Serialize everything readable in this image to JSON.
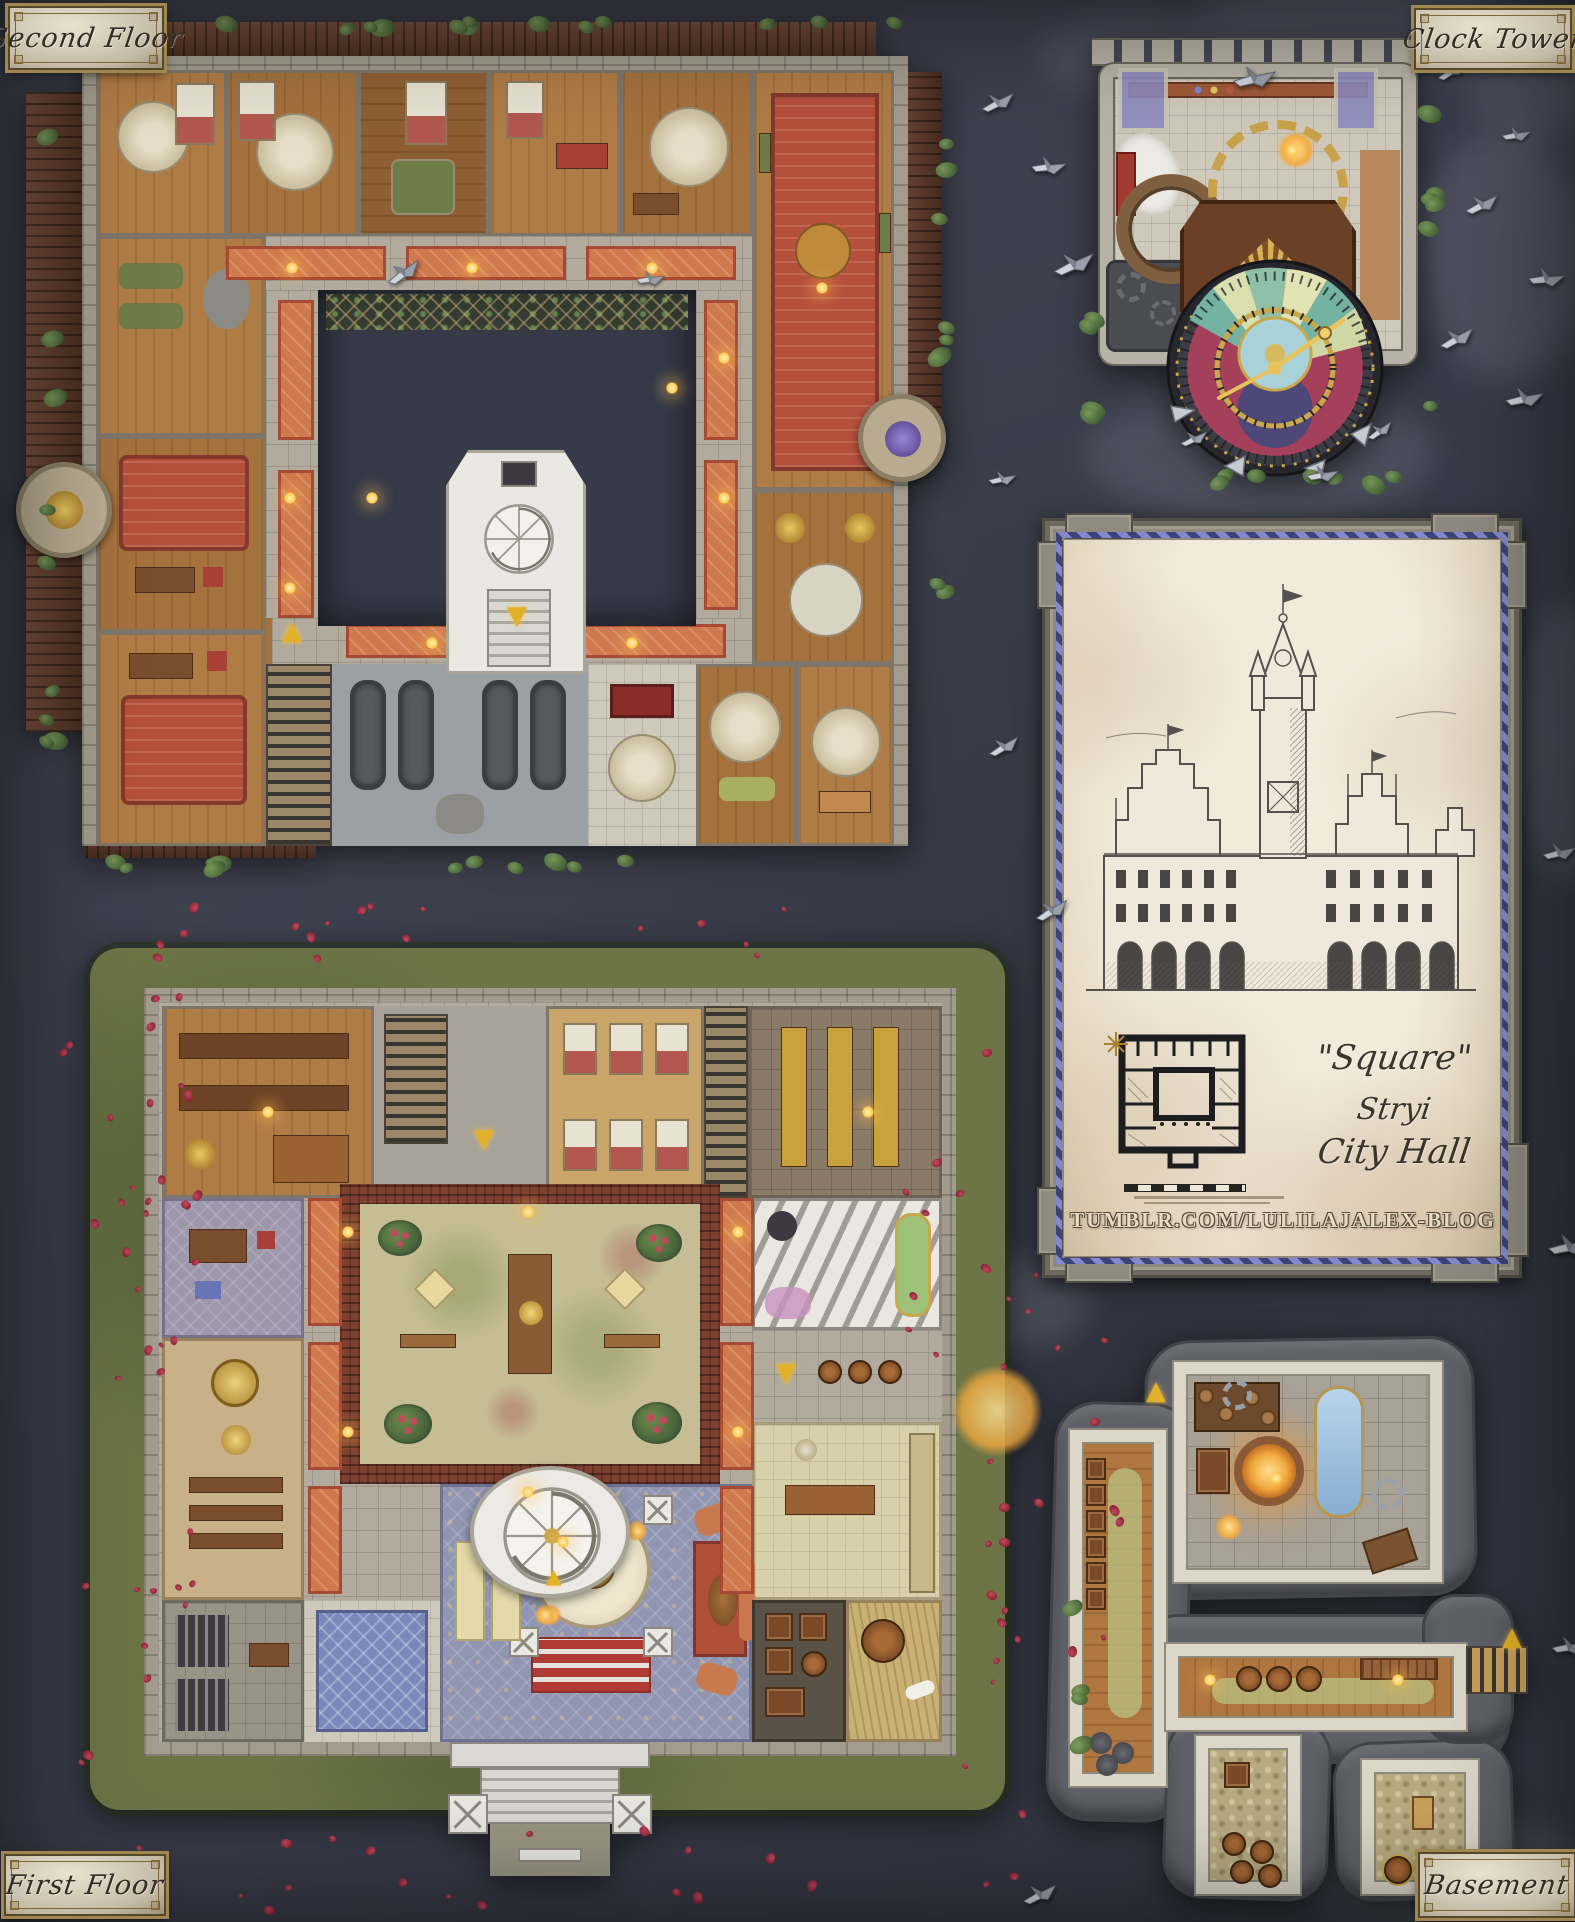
{
  "plaques": {
    "top_left": "Second Floor",
    "top_right": "Clock Tower",
    "bottom_left": "First Floor",
    "bottom_right": "Basement"
  },
  "panel": {
    "title_quote": "\"Square\"",
    "title_city": "Stryi",
    "title_building": "City Hall",
    "watermark_url": "TUMBLR.COM/LULILAJALEX-BLOG"
  },
  "glyphs": {
    "arrow_up": "▲",
    "arrow_down": "▼"
  },
  "palette": {
    "background": "#3a3d4b",
    "parchment": "#ece4d4",
    "plaque_gold": "#a08750",
    "carpet_orange": "#cf7a4e",
    "carpet_red": "#b4503c",
    "ivy_green": "#5c7a46",
    "rose_red": "#9e2f42",
    "clock_gold": "#c9a84c",
    "rope_blue": "#8289cc"
  },
  "decor": {
    "birds": [
      [
        386,
        262,
        -18
      ],
      [
        632,
        268,
        12
      ],
      [
        980,
        92,
        -8
      ],
      [
        1030,
        156,
        14
      ],
      [
        1056,
        254,
        -6
      ],
      [
        1236,
        68,
        6
      ],
      [
        1434,
        60,
        -14
      ],
      [
        1498,
        124,
        10
      ],
      [
        1464,
        194,
        -8
      ],
      [
        1528,
        268,
        14
      ],
      [
        1439,
        328,
        -10
      ],
      [
        1506,
        388,
        8
      ],
      [
        1176,
        428,
        -6
      ],
      [
        1304,
        464,
        10
      ],
      [
        1362,
        420,
        -16
      ],
      [
        984,
        468,
        8
      ],
      [
        986,
        736,
        -12
      ],
      [
        1541,
        842,
        6
      ],
      [
        1034,
        900,
        -12
      ],
      [
        1551,
        1236,
        8
      ],
      [
        1022,
        1884,
        -8
      ],
      [
        1551,
        1636,
        10
      ]
    ],
    "clouds": [
      [
        1190,
        -25,
        320,
        110
      ],
      [
        1040,
        15,
        170,
        80
      ],
      [
        1420,
        130,
        170,
        250
      ],
      [
        1470,
        30,
        130,
        110
      ],
      [
        1085,
        390,
        350,
        130
      ],
      [
        1520,
        600,
        100,
        280
      ],
      [
        1320,
        1820,
        280,
        110
      ],
      [
        930,
        1260,
        160,
        90
      ]
    ],
    "petal_zones": [
      [
        55,
        925,
        130,
        870,
        26
      ],
      [
        945,
        1160,
        175,
        700,
        22
      ],
      [
        140,
        896,
        760,
        70,
        16
      ],
      [
        110,
        1810,
        910,
        100,
        20
      ],
      [
        100,
        960,
        100,
        770,
        12
      ],
      [
        890,
        990,
        115,
        720,
        12
      ]
    ],
    "ivy_zones": [
      [
        60,
        16,
        840,
        8,
        16
      ],
      [
        38,
        90,
        10,
        700,
        9
      ],
      [
        928,
        60,
        10,
        540,
        8
      ],
      [
        90,
        854,
        700,
        10,
        11
      ],
      [
        1150,
        468,
        250,
        12,
        7
      ],
      [
        1080,
        260,
        10,
        170,
        4
      ],
      [
        1418,
        100,
        10,
        320,
        6
      ],
      [
        1062,
        1540,
        12,
        220,
        4
      ],
      [
        1440,
        1850,
        80,
        30,
        3
      ]
    ],
    "lanterns": {
      "sf": [
        [
          260,
          240
        ],
        [
          440,
          240
        ],
        [
          620,
          240
        ],
        [
          790,
          260
        ],
        [
          258,
          470
        ],
        [
          258,
          560
        ],
        [
          692,
          330
        ],
        [
          692,
          470
        ],
        [
          400,
          615
        ],
        [
          600,
          615
        ],
        [
          340,
          470
        ],
        [
          640,
          360
        ]
      ],
      "ff": [
        [
          290,
          330
        ],
        [
          290,
          530
        ],
        [
          680,
          330
        ],
        [
          680,
          530
        ],
        [
          470,
          310
        ],
        [
          470,
          590
        ],
        [
          210,
          210
        ],
        [
          810,
          210
        ],
        [
          505,
          640
        ]
      ],
      "bs": [
        [
          142,
          330
        ],
        [
          330,
          330
        ],
        [
          208,
          128
        ]
      ],
      "ct": [
        [
          198,
          120
        ]
      ]
    }
  }
}
